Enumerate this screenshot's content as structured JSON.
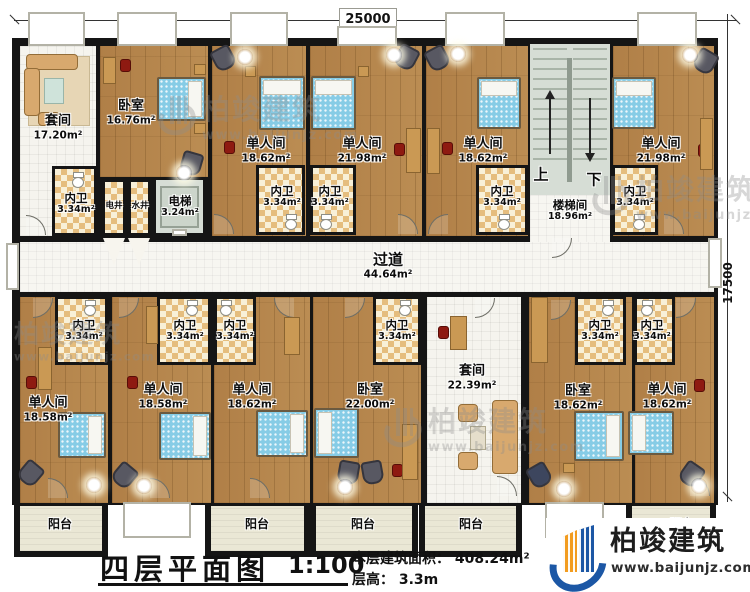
{
  "drawing": {
    "dim_top": "25000",
    "dim_right": "17500"
  },
  "rooms": {
    "suite_top": {
      "name": "套间",
      "area": "17.20m²"
    },
    "bedroom_top": {
      "name": "卧室",
      "area": "16.76m²"
    },
    "single_t1": {
      "name": "单人间",
      "area": "18.62m²"
    },
    "single_t2": {
      "name": "单人间",
      "area": "21.98m²"
    },
    "single_t3": {
      "name": "单人间",
      "area": "18.62m²"
    },
    "single_t4": {
      "name": "单人间",
      "area": "21.98m²"
    },
    "stairwell": {
      "name": "楼梯间",
      "area": "18.96m²",
      "up": "上",
      "down": "下"
    },
    "elevator": {
      "name": "电梯",
      "area": "3.24m²"
    },
    "shaft_electric": {
      "name": "电井"
    },
    "shaft_water": {
      "name": "水井"
    },
    "corridor": {
      "name": "过道",
      "area": "44.64m²"
    },
    "bathroom": {
      "name": "内卫",
      "area": "3.34m²"
    },
    "balcony": {
      "name": "阳台"
    },
    "single_b1": {
      "name": "单人间",
      "area": "18.58m²"
    },
    "single_b2": {
      "name": "单人间",
      "area": "18.58m²"
    },
    "single_b3": {
      "name": "单人间",
      "area": "18.62m²"
    },
    "bedroom_b1": {
      "name": "卧室",
      "area": "22.00m²"
    },
    "suite_bottom": {
      "name": "套间",
      "area": "22.39m²"
    },
    "bedroom_b2": {
      "name": "卧室",
      "area": "18.62m²"
    },
    "single_b4": {
      "name": "单人间",
      "area": "18.62m²"
    }
  },
  "title_block": {
    "title": "四层平面图",
    "scale": "1:100",
    "area_label": "本层建筑面积：",
    "area_value": "408.24m²",
    "height_label": "层高：",
    "height_value": "3.3m"
  },
  "branding": {
    "company": "柏竣建筑",
    "website": "www.baijunjz.com"
  },
  "watermark": {
    "company": "柏竣建筑",
    "website": "www.baijunjz.com"
  }
}
